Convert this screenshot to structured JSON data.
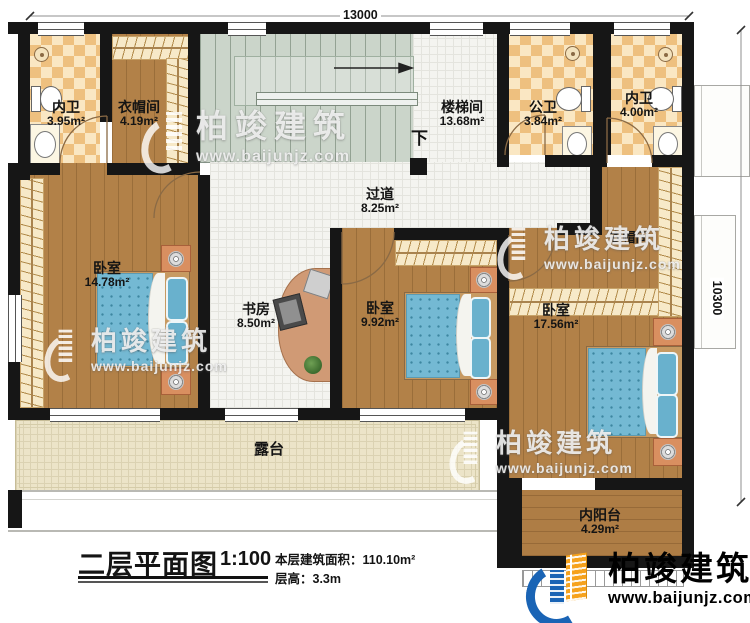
{
  "plan": {
    "dimensions": {
      "top": "13000",
      "right": "10300"
    },
    "stair_down": "下"
  },
  "rooms": {
    "bath_tl": {
      "name": "内卫",
      "area": "3.95m²"
    },
    "closet_tl": {
      "name": "衣帽间",
      "area": "4.19m²"
    },
    "stairwell": {
      "name": "楼梯间",
      "area": "13.68m²"
    },
    "bath_public": {
      "name": "公卫",
      "area": "3.84m²"
    },
    "bath_tr": {
      "name": "内卫",
      "area": "4.00m²"
    },
    "corridor": {
      "name": "过道",
      "area": "8.25m²"
    },
    "bedroom_left": {
      "name": "卧室",
      "area": "14.78m²"
    },
    "study": {
      "name": "书房",
      "area": "8.50m²"
    },
    "bedroom_mid": {
      "name": "卧室",
      "area": "9.92m²"
    },
    "bedroom_right": {
      "name": "卧室",
      "area": "17.56m²"
    },
    "closet_right": {
      "name": "衣帽间"
    },
    "terrace": {
      "name": "露台"
    },
    "balcony": {
      "name": "内阳台",
      "area": "4.29m²"
    }
  },
  "title_block": {
    "title": "二层平面图",
    "scale": "1:100",
    "area_line": "本层建筑面积：110.10m²",
    "floor_height_line": "层高：3.3m"
  },
  "brand": {
    "name": "柏竣建筑",
    "url": "www.baijunjz.com"
  },
  "colors": {
    "wall": "#161616",
    "wood": "#b28148",
    "bath_tile": "#eec07f",
    "brand_blue": "#1a64b5",
    "brand_orange": "#f6a21d",
    "bed_blue": "#74b9d3"
  }
}
